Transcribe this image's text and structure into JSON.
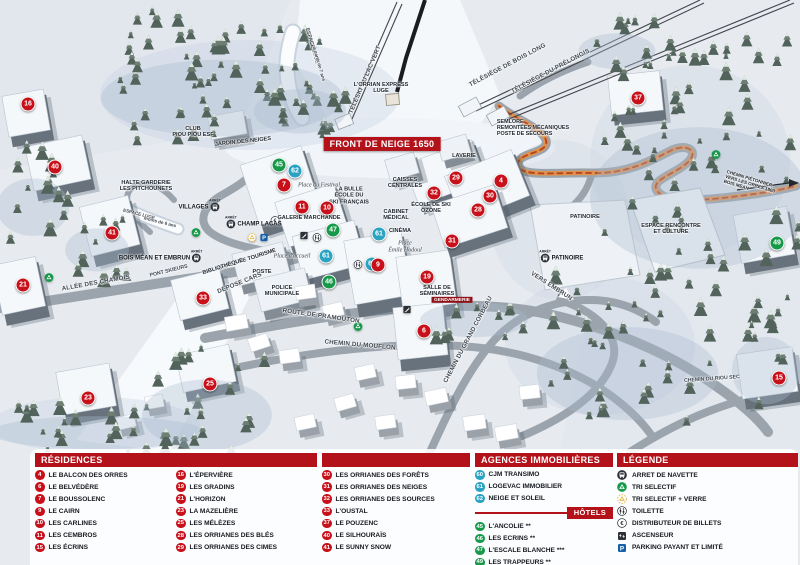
{
  "colors": {
    "header_red": "#b3121a",
    "marker_red": "#c8101a",
    "hotel_green": "#169a4a",
    "agency_blue": "#2aa3c2",
    "path_orange": "#e0914a"
  },
  "map": {
    "arret_label": "ARRÊT",
    "labels": [
      {
        "t": "FRONT DE NEIGE 1650",
        "x": 382,
        "y": 144,
        "s": "sign"
      },
      {
        "t": "ESPACE LUGE",
        "x": 311,
        "y": 46,
        "r": 74,
        "s": "roadsmall"
      },
      {
        "t": "à partir de 7 ans",
        "x": 319,
        "y": 64,
        "r": 74,
        "s": "roadmicro"
      },
      {
        "t": "TÉLÉSKI DU LAC VERT",
        "x": 366,
        "y": 80,
        "r": -67,
        "s": "road"
      },
      {
        "t": "L'ORRIAN EXPRESS\nLUGE",
        "x": 381,
        "y": 88,
        "s": "tiny"
      },
      {
        "t": "TÉLÉSIÈGE DE BOIS LONG",
        "x": 508,
        "y": 66,
        "r": -28,
        "s": "road"
      },
      {
        "t": "TÉLÉSIÈGE DU PRÉLONGIS",
        "x": 551,
        "y": 72,
        "r": -28,
        "s": "road"
      },
      {
        "t": "SEMLORE\nREMONTÉES MÉCANIQUES\nPOSTE DE SECOURS",
        "x": 533,
        "y": 128,
        "s": "info"
      },
      {
        "t": "CLUB\nPIOU PIOU ESF",
        "x": 193,
        "y": 132,
        "s": "tiny"
      },
      {
        "t": "JARDIN DES NEIGES",
        "x": 243,
        "y": 142,
        "r": -6,
        "s": "tiny"
      },
      {
        "t": "HALTE GARDERIE\nLES PITCHOUNETS",
        "x": 146,
        "y": 186,
        "s": "tiny"
      },
      {
        "t": "ESPACE LUGE",
        "x": 139,
        "y": 214,
        "r": 14,
        "s": "roadmicro"
      },
      {
        "t": "moins de 6 ans",
        "x": 160,
        "y": 222,
        "r": 14,
        "s": "roadmicro"
      },
      {
        "t": "LA BULLE\nÉCOLE DU\nSKI FRANÇAIS",
        "x": 349,
        "y": 196,
        "s": "tiny"
      },
      {
        "t": "Place du Festival",
        "x": 319,
        "y": 186,
        "s": "italic"
      },
      {
        "t": "GALERIE MARCHANDE",
        "x": 309,
        "y": 218,
        "s": "tiny"
      },
      {
        "t": "CAISSES\nCENTRALES",
        "x": 405,
        "y": 183,
        "s": "tiny"
      },
      {
        "t": "CABINET\nMÉDICAL",
        "x": 396,
        "y": 215,
        "s": "tiny"
      },
      {
        "t": "CINÉMA",
        "x": 400,
        "y": 231,
        "s": "tiny"
      },
      {
        "t": "Place\nÉmile Hodoul",
        "x": 405,
        "y": 247,
        "s": "italic"
      },
      {
        "t": "ÉCOLE DE SKI\nOZONE",
        "x": 431,
        "y": 208,
        "s": "tiny"
      },
      {
        "t": "LAVERIE",
        "x": 464,
        "y": 156,
        "s": "tiny"
      },
      {
        "t": "OFFICE DE TOURISME",
        "x": 247,
        "y": 260,
        "r": -18,
        "s": "tiny"
      },
      {
        "t": "BIBLIOTHÈQUE",
        "x": 223,
        "y": 267,
        "r": -18,
        "s": "tiny"
      },
      {
        "t": "POSTE",
        "x": 262,
        "y": 272,
        "s": "tiny"
      },
      {
        "t": "DÉPOSE CARS",
        "x": 240,
        "y": 284,
        "r": -22,
        "s": "road"
      },
      {
        "t": "POLICE\nMUNICIPALE",
        "x": 282,
        "y": 291,
        "s": "tiny"
      },
      {
        "t": "Place d'accueil",
        "x": 292,
        "y": 257,
        "s": "italic"
      },
      {
        "t": "SALLE DE\nSÉMINAIRES",
        "x": 437,
        "y": 291,
        "s": "tiny"
      },
      {
        "t": "GENDARMERIE",
        "x": 452,
        "y": 300,
        "s": "redbox"
      },
      {
        "t": "PATINOIRE",
        "x": 585,
        "y": 217,
        "s": "tiny"
      },
      {
        "t": "ESPACE RENCONTRE\nET CULTURE",
        "x": 671,
        "y": 229,
        "s": "tiny"
      },
      {
        "t": "VERS EMBRUN",
        "x": 551,
        "y": 287,
        "r": 33,
        "s": "road"
      },
      {
        "t": "CHEMIN PIÉTONNIER\nVERS LES ORRES 1800\nBOIS MÉAN",
        "x": 750,
        "y": 184,
        "r": 17,
        "s": "roadmicro-left"
      },
      {
        "t": "ALLÉE DES CHAMOIS",
        "x": 96,
        "y": 284,
        "r": -10,
        "s": "road"
      },
      {
        "t": "PONT SKIEURS",
        "x": 169,
        "y": 272,
        "r": -14,
        "s": "roadsmall"
      },
      {
        "t": "ROUTE DE PRAMOUTON",
        "x": 321,
        "y": 317,
        "r": 8,
        "s": "road"
      },
      {
        "t": "CHEMIN DU MOUFLON",
        "x": 360,
        "y": 346,
        "r": 5,
        "s": "road"
      },
      {
        "t": "CHEMIN DU GRAND CORBEAU",
        "x": 469,
        "y": 340,
        "r": -62,
        "s": "road"
      },
      {
        "t": "CHEMIN DU RIOU SEC",
        "x": 712,
        "y": 380,
        "r": -4,
        "s": "roadsmall"
      }
    ],
    "bus_stops": [
      {
        "label": "VILLAGES",
        "x": 199,
        "y": 207,
        "side": "right"
      },
      {
        "label": "CHAMP LACAS",
        "x": 254,
        "y": 224,
        "side": "left"
      },
      {
        "label": "BOIS MÉAN ET EMBRUN",
        "x": 160,
        "y": 258,
        "side": "right"
      },
      {
        "label": "PATINOIRE",
        "x": 562,
        "y": 258,
        "side": "left"
      }
    ],
    "markers": [
      {
        "n": "16",
        "c": "res",
        "x": 28,
        "y": 104
      },
      {
        "n": "40",
        "c": "res",
        "x": 55,
        "y": 167
      },
      {
        "n": "41",
        "c": "res",
        "x": 112,
        "y": 233
      },
      {
        "n": "21",
        "c": "res",
        "x": 23,
        "y": 285
      },
      {
        "n": "33",
        "c": "res",
        "x": 203,
        "y": 298
      },
      {
        "n": "23",
        "c": "res",
        "x": 88,
        "y": 398
      },
      {
        "n": "25",
        "c": "res",
        "x": 210,
        "y": 384
      },
      {
        "n": "45",
        "c": "ht",
        "x": 279,
        "y": 165
      },
      {
        "n": "62",
        "c": "ag",
        "x": 295,
        "y": 171
      },
      {
        "n": "7",
        "c": "res",
        "x": 284,
        "y": 185
      },
      {
        "n": "11",
        "c": "res",
        "x": 302,
        "y": 207
      },
      {
        "n": "10",
        "c": "res",
        "x": 327,
        "y": 208
      },
      {
        "n": "47",
        "c": "ht",
        "x": 333,
        "y": 230
      },
      {
        "n": "61",
        "c": "ag",
        "x": 379,
        "y": 234
      },
      {
        "n": "61",
        "c": "ag",
        "x": 326,
        "y": 256
      },
      {
        "n": "60",
        "c": "ag",
        "x": 372,
        "y": 264
      },
      {
        "n": "46",
        "c": "ht",
        "x": 329,
        "y": 282
      },
      {
        "n": "9",
        "c": "res",
        "x": 378,
        "y": 265
      },
      {
        "n": "19",
        "c": "res",
        "x": 427,
        "y": 277
      },
      {
        "n": "6",
        "c": "res",
        "x": 424,
        "y": 331
      },
      {
        "n": "29",
        "c": "res",
        "x": 456,
        "y": 178
      },
      {
        "n": "4",
        "c": "res",
        "x": 501,
        "y": 181
      },
      {
        "n": "32",
        "c": "res",
        "x": 434,
        "y": 193
      },
      {
        "n": "30",
        "c": "res",
        "x": 490,
        "y": 196
      },
      {
        "n": "28",
        "c": "res",
        "x": 478,
        "y": 210
      },
      {
        "n": "31",
        "c": "res",
        "x": 452,
        "y": 241
      },
      {
        "n": "37",
        "c": "res",
        "x": 638,
        "y": 98
      },
      {
        "n": "49",
        "c": "ht",
        "x": 777,
        "y": 243
      },
      {
        "n": "15",
        "c": "res",
        "x": 779,
        "y": 378
      }
    ],
    "icons": [
      {
        "type": "recycle-green",
        "x": 196,
        "y": 233
      },
      {
        "type": "recycle-green",
        "x": 358,
        "y": 327
      },
      {
        "type": "recycle-green",
        "x": 49,
        "y": 278
      },
      {
        "type": "recycle-green",
        "x": 716,
        "y": 155
      },
      {
        "type": "recycle-yellow",
        "x": 252,
        "y": 238
      },
      {
        "type": "parking",
        "x": 264,
        "y": 238
      },
      {
        "type": "euro",
        "x": 275,
        "y": 221
      },
      {
        "type": "wc",
        "x": 317,
        "y": 238
      },
      {
        "type": "wc",
        "x": 358,
        "y": 265
      },
      {
        "type": "stairs",
        "x": 304,
        "y": 236
      },
      {
        "type": "stairs",
        "x": 407,
        "y": 310
      }
    ]
  },
  "legend_panel": {
    "residences": {
      "title": "RÉSIDENCES",
      "col_a": [
        {
          "n": "4",
          "label": "LE BALCON DES ORRES"
        },
        {
          "n": "6",
          "label": "LE BELVÉDÈRE"
        },
        {
          "n": "7",
          "label": "LE BOUSSOLENC"
        },
        {
          "n": "9",
          "label": "LE CAIRN"
        },
        {
          "n": "10",
          "label": "LES CARLINES"
        },
        {
          "n": "11",
          "label": "LES CEMBROS"
        },
        {
          "n": "15",
          "label": "LES ÉCRINS"
        }
      ],
      "col_b": [
        {
          "n": "16",
          "label": "L'ÉPERVIÈRE"
        },
        {
          "n": "19",
          "label": "LES GRADINS"
        },
        {
          "n": "21",
          "label": "L'HORIZON"
        },
        {
          "n": "23",
          "label": "LA MAZELIÈRE"
        },
        {
          "n": "25",
          "label": "LES MÉLÈZES"
        },
        {
          "n": "28",
          "label": "LES ORRIANES DES BLÉS"
        },
        {
          "n": "29",
          "label": "LES ORRIANES DES CIMES"
        }
      ],
      "col_c": [
        {
          "n": "30",
          "label": "LES ORRIANES DES FORÊTS"
        },
        {
          "n": "31",
          "label": "LES ORRIANES DES NEIGES"
        },
        {
          "n": "32",
          "label": "LES ORRIANES DES SOURCES"
        },
        {
          "n": "33",
          "label": "L'OUSTAL"
        },
        {
          "n": "37",
          "label": "LE POUZENC"
        },
        {
          "n": "40",
          "label": "LE SILHOURAÏS"
        },
        {
          "n": "41",
          "label": "LE SUNNY SNOW"
        }
      ]
    },
    "agencies": {
      "title": "AGENCES IMMOBILIÈRES",
      "items": [
        {
          "n": "60",
          "label": "CJM TRANSIMO"
        },
        {
          "n": "61",
          "label": "LOGEVAC IMMOBILIER"
        },
        {
          "n": "62",
          "label": "NEIGE ET SOLEIL"
        }
      ]
    },
    "hotels": {
      "title": "HÔTELS",
      "items": [
        {
          "n": "45",
          "label": "L'ANCOLIE **"
        },
        {
          "n": "46",
          "label": "LES ECRINS **"
        },
        {
          "n": "47",
          "label": "L'ESCALE BLANCHE ***"
        },
        {
          "n": "49",
          "label": "LES TRAPPEURS **"
        }
      ]
    },
    "legende": {
      "title": "LÉGENDE",
      "items": [
        {
          "icon": "bus",
          "label": "ARRET DE NAVETTE"
        },
        {
          "icon": "recycle-green",
          "label": "TRI SELECTIF"
        },
        {
          "icon": "recycle-yellow",
          "label": "TRI SELECTIF + VERRE"
        },
        {
          "icon": "wc",
          "label": "TOILETTE"
        },
        {
          "icon": "euro",
          "label": "DISTRIBUTEUR DE BILLETS"
        },
        {
          "icon": "elevator",
          "label": "ASCENSEUR"
        },
        {
          "icon": "parking",
          "label": "PARKING PAYANT ET LIMITÉ"
        }
      ]
    }
  }
}
